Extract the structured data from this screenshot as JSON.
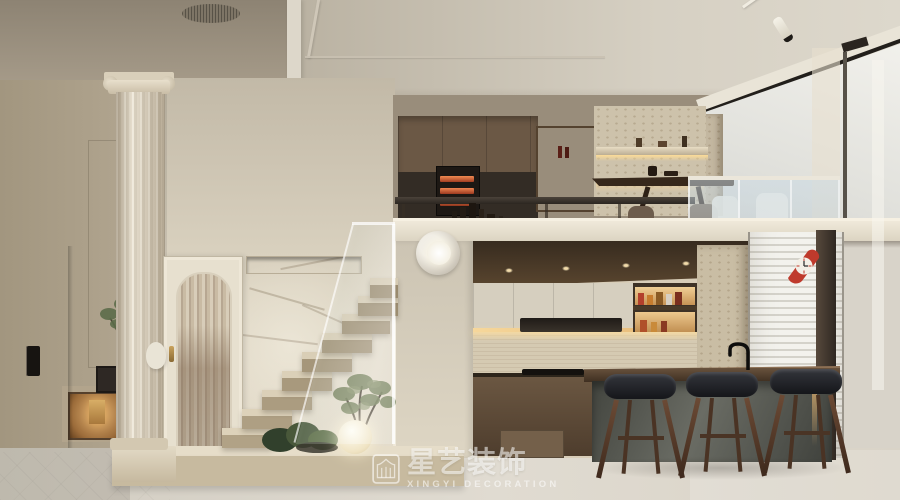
{
  "watermark": {
    "icon": "xingyi-pavilion-logo",
    "brand_cn": "星艺装饰",
    "brand_en": "XINGYI DECORATION"
  },
  "scene": {
    "type": "interior-design-render",
    "room": "Cream duplex loft: living hall with classical column and arched door, floating travertine staircase with indoor plants and moon lamp, open kitchen with bar island and three leather stools, mezzanine tea loft with backlit shelving and glass railing",
    "palette": {
      "accent_red": "#bf3a2c",
      "warm_glow": "#edc183",
      "travertine": "#cbbfa6",
      "wood_dark": "#45351f",
      "wood_cabinet": "#6d5942",
      "cream_wall": "#ddd5c3",
      "taupe_wall": "#a99d8a",
      "ceiling_dark": "#968b7a",
      "ceiling_light": "#d2ccbe",
      "island_base": "#565850",
      "stool_seat": "#1f2023",
      "stool_wood": "#5c3e2d",
      "floor": "#d8d3c9",
      "curtain": "#dbd1bd",
      "window_light": "#eeede8",
      "watermark_white": "#ffffff"
    }
  }
}
